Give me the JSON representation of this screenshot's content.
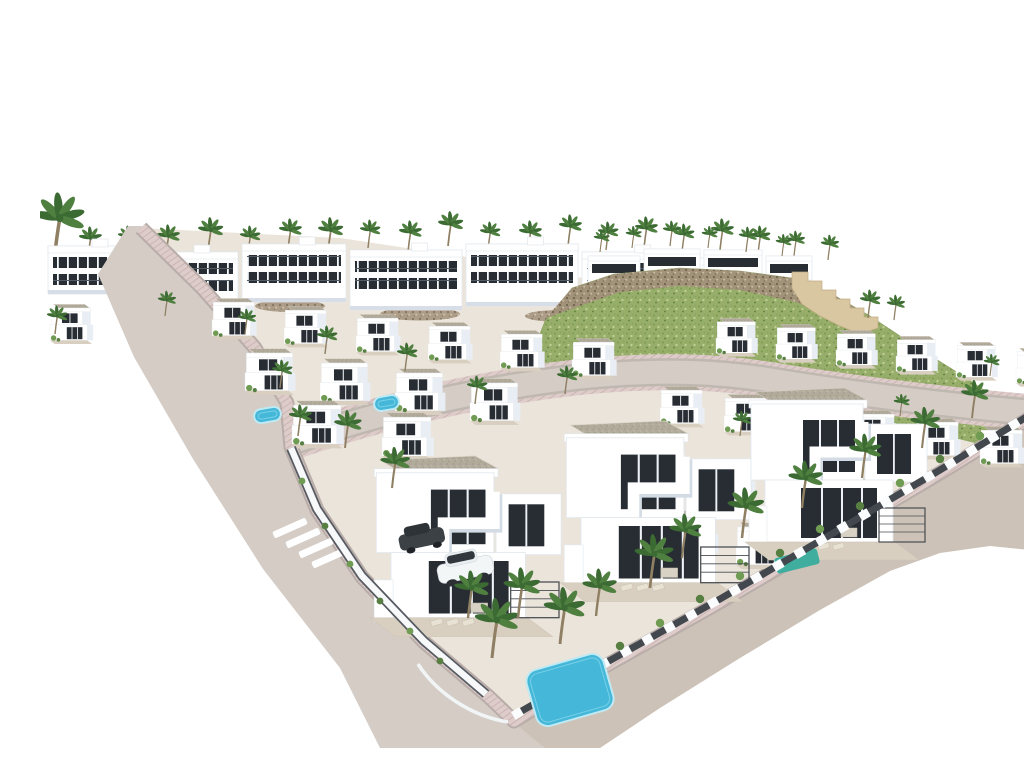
{
  "scene": {
    "description": "Aerial 3D architectural rendering of a hillside residential development: rows of modern white flat-roofed villas with gravel roofs, dark glass openings, private pools, palm trees and landscaped gardens, bounded by a curved grey road with a pink paved sidewalk and a zebra crosswalk; a green rocky hill with a stepped sand-coloured retaining wall rises behind the houses on the right; background and margins are pure white.",
    "render_type": "3D architectural visualization, isometric aerial view",
    "palette": {
      "background": "#ffffff",
      "building_white": "#ffffff",
      "building_stroke": "#e2e8ee",
      "building_shade": "#e9eef4",
      "building_shade_dark": "#d7dee8",
      "window_dark": "#272d33",
      "roof_gravel": "#b2ab9c",
      "terrace_floor": "#d9cfc0",
      "ground_base": "#ebe4da",
      "road": "#d4ccc5",
      "road_curb": "#bfb8b0",
      "sidewalk_pink": "#deccca",
      "sidewalk_curb": "#b9ada9",
      "hill_grass": "#97ad6a",
      "rock": "#a2917a",
      "rock_dark": "#6f614c",
      "retaining_wall": "#d9c7a2",
      "pool_water": "#45b7d8",
      "pool_edge": "#bfeaf4",
      "awning_teal": "#3fae9e",
      "palm_green": "#4f8040",
      "palm_green_dark": "#3c6a33",
      "bush_green": "#6f9b53",
      "trunk_brown": "#8f7f63",
      "fence_dark": "#43484e",
      "dirt_ground": "#ccc2b8",
      "car_white": "#f3f6f7",
      "car_dark": "#3c4146"
    },
    "inventory": {
      "apartment_blocks": 7,
      "hilltop_houses": 4,
      "villas": 35,
      "palm_trees": 56,
      "swimming_pools": 3,
      "cars": 2,
      "roads": 2,
      "crosswalks": 1
    }
  }
}
